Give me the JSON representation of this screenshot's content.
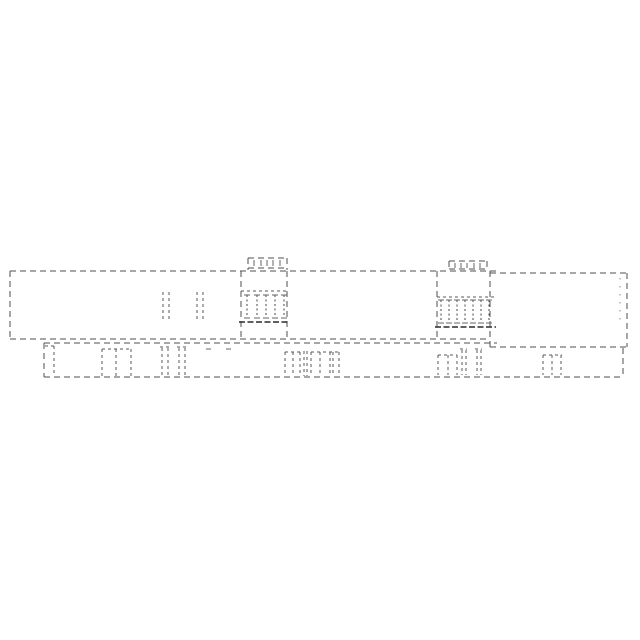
{
  "page": {
    "background": "#ffffff",
    "width": 640,
    "height": 640
  },
  "drawing": {
    "name": "dashed-building-elevation",
    "description_colors": {
      "line": "#4f4f4f",
      "line_dark": "#2b2b2b",
      "background": "#ffffff"
    },
    "groups": [
      {
        "name": "upper-band-outline",
        "lines": [
          [
            10,
            271,
            497,
            271,
            "edge"
          ],
          [
            490,
            273,
            627,
            273,
            "edge"
          ],
          [
            10,
            271,
            10,
            339,
            "edge"
          ],
          [
            10,
            339,
            490,
            339,
            "edge"
          ],
          [
            490,
            347,
            627,
            347,
            "edge"
          ],
          [
            627,
            273,
            627,
            347,
            "edge"
          ],
          [
            620,
            278,
            620,
            324,
            "sparse"
          ]
        ]
      },
      {
        "name": "upper-band-windows",
        "lines": [
          [
            163,
            292,
            163,
            322,
            "win"
          ],
          [
            169,
            292,
            169,
            322,
            "win"
          ],
          [
            197,
            292,
            197,
            322,
            "win"
          ],
          [
            203,
            292,
            203,
            322,
            "win"
          ]
        ]
      },
      {
        "name": "tower-1",
        "lines": [
          [
            248,
            258,
            287,
            258,
            "edge"
          ],
          [
            248,
            258,
            248,
            270,
            "edge"
          ],
          [
            287,
            258,
            287,
            270,
            "edge"
          ],
          [
            248,
            268,
            287,
            268,
            "edge"
          ],
          [
            254,
            260,
            254,
            266,
            "tick"
          ],
          [
            261,
            260,
            261,
            266,
            "tick"
          ],
          [
            267,
            260,
            267,
            266,
            "tick"
          ],
          [
            273,
            260,
            273,
            266,
            "tick"
          ],
          [
            280,
            260,
            280,
            266,
            "tick"
          ],
          [
            241,
            271,
            241,
            339,
            "edge"
          ],
          [
            287,
            271,
            287,
            339,
            "edge"
          ],
          [
            241,
            291,
            287,
            291,
            "win"
          ],
          [
            239,
            322,
            289,
            322,
            "dark"
          ]
        ],
        "hatch": {
          "xs": [
            247,
            257,
            266,
            275,
            284
          ],
          "y1": 295,
          "y2": 318,
          "serif": 3
        }
      },
      {
        "name": "tower-2",
        "lines": [
          [
            449,
            261,
            487,
            261,
            "edge"
          ],
          [
            449,
            261,
            449,
            271,
            "edge"
          ],
          [
            487,
            261,
            487,
            271,
            "edge"
          ],
          [
            449,
            269,
            487,
            269,
            "edge"
          ],
          [
            455,
            263,
            455,
            268,
            "tick"
          ],
          [
            461,
            263,
            461,
            268,
            "tick"
          ],
          [
            467,
            263,
            467,
            268,
            "tick"
          ],
          [
            474,
            263,
            474,
            268,
            "tick"
          ],
          [
            480,
            263,
            480,
            268,
            "tick"
          ],
          [
            437,
            271,
            437,
            339,
            "edge"
          ],
          [
            490,
            271,
            490,
            347,
            "edge"
          ],
          [
            437,
            297,
            494,
            297,
            "win"
          ],
          [
            435,
            327,
            496,
            327,
            "dark"
          ]
        ],
        "hatch": {
          "xs": [
            441,
            449,
            457,
            465,
            473,
            481,
            489
          ],
          "y1": 300,
          "y2": 323,
          "serif": 3
        }
      },
      {
        "name": "lower-band-outline",
        "lines": [
          [
            44,
            343,
            497,
            343,
            "edge"
          ],
          [
            44,
            343,
            44,
            377,
            "edge"
          ],
          [
            44,
            377,
            623,
            377,
            "edge"
          ],
          [
            623,
            348,
            623,
            377,
            "edge"
          ]
        ]
      },
      {
        "name": "lower-band-windows",
        "lines": [
          [
            45,
            346,
            54,
            346,
            "win"
          ],
          [
            54,
            346,
            54,
            375,
            "win"
          ],
          [
            102,
            349,
            131,
            349,
            "win"
          ],
          [
            102,
            349,
            102,
            376,
            "win"
          ],
          [
            116,
            349,
            116,
            376,
            "win"
          ],
          [
            131,
            349,
            131,
            376,
            "win"
          ],
          [
            160,
            347,
            170,
            347,
            "win"
          ],
          [
            162,
            348,
            162,
            376,
            "win"
          ],
          [
            168,
            348,
            168,
            376,
            "win"
          ],
          [
            177,
            347,
            186,
            347,
            "win"
          ],
          [
            179,
            348,
            179,
            376,
            "win"
          ],
          [
            185,
            348,
            185,
            376,
            "win"
          ],
          [
            206,
            349,
            211,
            349,
            "tick"
          ],
          [
            226,
            349,
            231,
            349,
            "tick"
          ],
          [
            285,
            352,
            301,
            352,
            "win"
          ],
          [
            285,
            352,
            285,
            376,
            "win"
          ],
          [
            293,
            352,
            293,
            376,
            "win"
          ],
          [
            300,
            352,
            300,
            376,
            "win"
          ],
          [
            304,
            351,
            304,
            376,
            "win"
          ],
          [
            307,
            351,
            307,
            376,
            "win"
          ],
          [
            311,
            352,
            340,
            352,
            "win"
          ],
          [
            311,
            352,
            311,
            376,
            "win"
          ],
          [
            320,
            352,
            320,
            376,
            "win"
          ],
          [
            330,
            352,
            330,
            376,
            "win"
          ],
          [
            333,
            352,
            333,
            376,
            "win"
          ],
          [
            339,
            352,
            339,
            376,
            "win"
          ],
          [
            438,
            355,
            457,
            355,
            "win"
          ],
          [
            438,
            355,
            438,
            375,
            "win"
          ],
          [
            448,
            355,
            448,
            375,
            "win"
          ],
          [
            457,
            355,
            457,
            375,
            "win"
          ],
          [
            460,
            349,
            467,
            349,
            "win"
          ],
          [
            462,
            350,
            462,
            375,
            "win"
          ],
          [
            466,
            350,
            466,
            375,
            "win"
          ],
          [
            475,
            349,
            482,
            349,
            "win"
          ],
          [
            477,
            350,
            477,
            375,
            "win"
          ],
          [
            481,
            350,
            481,
            375,
            "win"
          ],
          [
            543,
            355,
            562,
            355,
            "win"
          ],
          [
            543,
            355,
            543,
            375,
            "win"
          ],
          [
            552,
            355,
            552,
            375,
            "win"
          ],
          [
            561,
            355,
            561,
            375,
            "win"
          ]
        ]
      }
    ]
  }
}
